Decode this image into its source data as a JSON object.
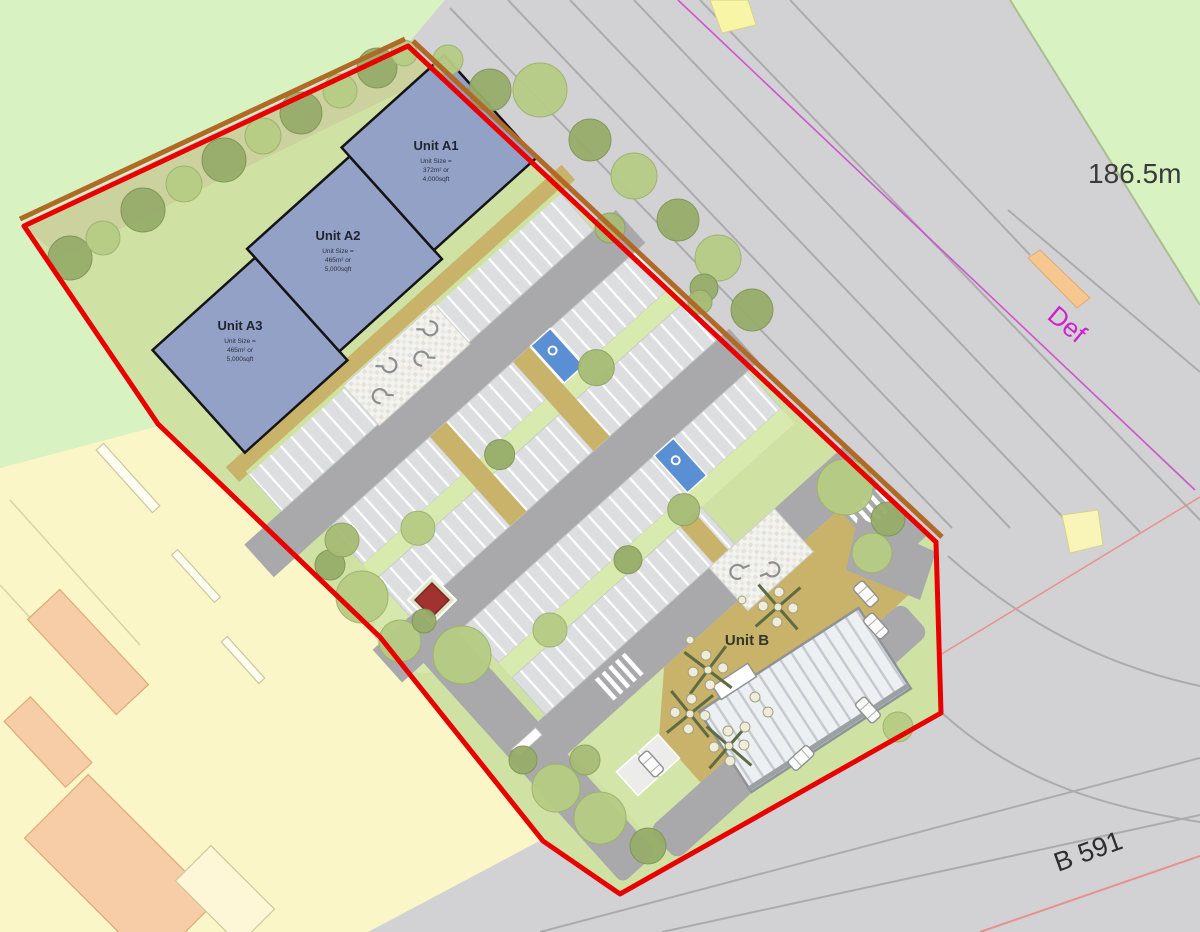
{
  "units": {
    "a1": {
      "name": "Unit A1",
      "l1": "Unit Size =",
      "l2": "372m² or",
      "l3": "4,000sqft"
    },
    "a2": {
      "name": "Unit A2",
      "l1": "Unit Size =",
      "l2": "465m² or",
      "l3": "5,000sqft"
    },
    "a3": {
      "name": "Unit A3",
      "l1": "Unit Size =",
      "l2": "465m² or",
      "l3": "5,000sqft"
    },
    "b": {
      "name": "Unit B"
    }
  },
  "labels": {
    "spot_height": "186.5m",
    "definitive_path": "Def",
    "road_name": "B 591"
  },
  "legend": {
    "boundary_color": "#e80000",
    "unit_fill": "#93a1c6",
    "road_color": "#a9a9ab",
    "landscape_color": "#cfe2a4",
    "plaza_color": "#c9b269",
    "field_color": "#d9f2c1",
    "parcel_color": "#fbf6c8",
    "def_color": "#cc22cc"
  }
}
